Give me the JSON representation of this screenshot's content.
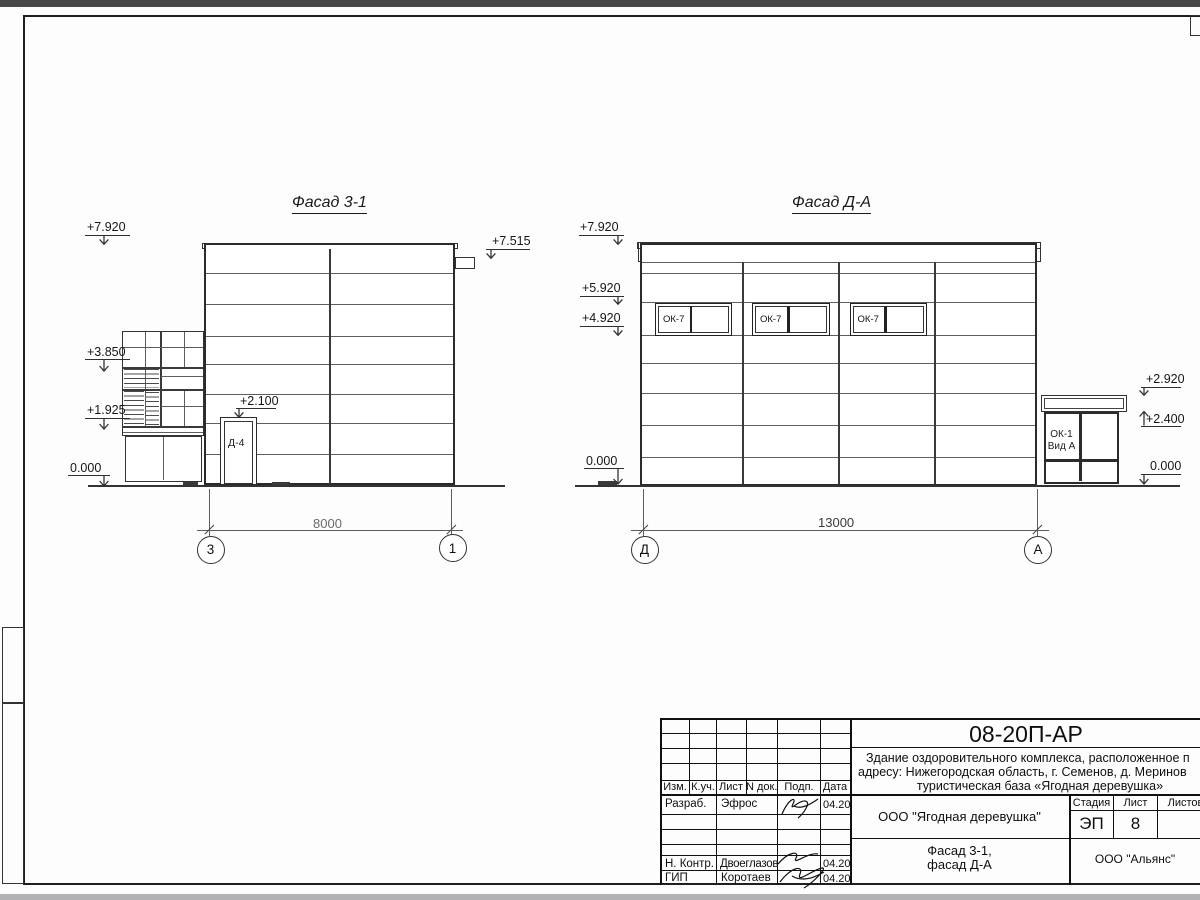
{
  "colors": {
    "top_bar": "#47484a",
    "bottom_bar": "#b2b2b4",
    "line_dark": "#2b2b2b",
    "line_thin": "#5e5e5e"
  },
  "facade_left": {
    "title": "Фасад 3-1",
    "door_label": "Д-4",
    "elev_7920": "+7.920",
    "elev_3850": "+3.850",
    "elev_1925": "+1.925",
    "elev_0000": "0.000",
    "elev_door": "+2.100",
    "elev_7515": "+7.515",
    "dimension": "8000",
    "axis_left": "3",
    "axis_right": "1"
  },
  "facade_right": {
    "title": "Фасад Д-А",
    "window_label": "ОК-7",
    "annex_label_line1": "ОК-1",
    "annex_label_line2": "Вид А",
    "elev_7920": "+7.920",
    "elev_5920": "+5.920",
    "elev_4920": "+4.920",
    "elev_0000_left": "0.000",
    "elev_2920": "+2.920",
    "elev_2400": "+2.400",
    "elev_0000_right": "0.000",
    "dimension": "13000",
    "axis_left": "Д",
    "axis_right": "А"
  },
  "title_block": {
    "doc_code": "08-20П-АР",
    "description_line1": "Здание оздоровительного комплекса, расположенное п",
    "description_line2": "адресу: Нижегородская область, г. Семенов, д. Меринов",
    "description_line3": "туристическая база «Ягодная деревушка»",
    "col_izm": "Изм.",
    "col_kuch": "К.уч.",
    "col_list": "Лист",
    "col_ndok": "N док.",
    "col_podp": "Подп.",
    "col_data": "Дата",
    "row1_role": "Разраб.",
    "row1_name": "Эфрос",
    "row1_date": "04.20",
    "row2_role": "Н. Контр.",
    "row2_name": "Двоеглазов",
    "row2_date": "04.20",
    "row3_role": "ГИП",
    "row3_name": "Коротаев",
    "row3_date": "04.20",
    "org": "ООО \"Ягодная деревушка\"",
    "stage_label": "Стадия",
    "sheet_label": "Лист",
    "sheets_label": "Листов",
    "stage": "ЭП",
    "sheet_no": "8",
    "drawing_name_line1": "Фасад 3-1,",
    "drawing_name_line2": "фасад Д-А",
    "company": "ООО \"Альянс\""
  }
}
